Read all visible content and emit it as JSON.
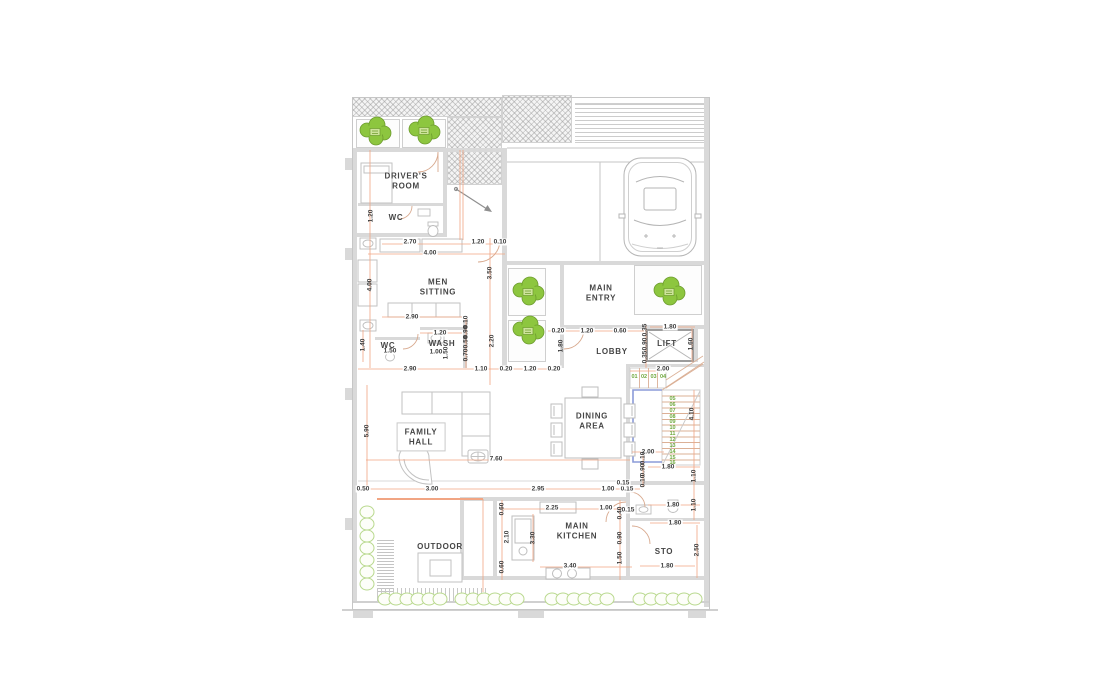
{
  "plan": {
    "rooms": [
      {
        "label": "DRIVER'S\nROOM",
        "x": 406,
        "y": 181
      },
      {
        "label": "WC",
        "x": 396,
        "y": 218
      },
      {
        "label": "MEN\nSITTING",
        "x": 438,
        "y": 287
      },
      {
        "label": "WASH",
        "x": 442,
        "y": 344
      },
      {
        "label": "WC",
        "x": 388,
        "y": 346
      },
      {
        "label": "MAIN\nENTRY",
        "x": 601,
        "y": 293
      },
      {
        "label": "LOBBY",
        "x": 612,
        "y": 352
      },
      {
        "label": "LIFT",
        "x": 667,
        "y": 344
      },
      {
        "label": "FAMILY\nHALL",
        "x": 421,
        "y": 437,
        "boxed": true
      },
      {
        "label": "DINING\nAREA",
        "x": 592,
        "y": 421
      },
      {
        "label": "MAIN\nKITCHEN",
        "x": 577,
        "y": 531
      },
      {
        "label": "STO",
        "x": 664,
        "y": 552
      },
      {
        "label": "OUTDOOR",
        "x": 440,
        "y": 547
      }
    ],
    "dims_horizontal": [
      {
        "t": "2.70",
        "x": 410,
        "y": 242
      },
      {
        "t": "4.00",
        "x": 430,
        "y": 253
      },
      {
        "t": "1.20",
        "x": 478,
        "y": 242
      },
      {
        "t": "0.10",
        "x": 500,
        "y": 242
      },
      {
        "t": "2.90",
        "x": 412,
        "y": 317
      },
      {
        "t": "1.20",
        "x": 440,
        "y": 333
      },
      {
        "t": "1.00",
        "x": 436,
        "y": 352
      },
      {
        "t": "1.50",
        "x": 390,
        "y": 351
      },
      {
        "t": "2.90",
        "x": 410,
        "y": 369
      },
      {
        "t": "1.10",
        "x": 481,
        "y": 369
      },
      {
        "t": "0.20",
        "x": 506,
        "y": 369
      },
      {
        "t": "1.20",
        "x": 530,
        "y": 369
      },
      {
        "t": "0.20",
        "x": 554,
        "y": 369
      },
      {
        "t": "0.20",
        "x": 558,
        "y": 331
      },
      {
        "t": "1.20",
        "x": 587,
        "y": 331
      },
      {
        "t": "0.60",
        "x": 620,
        "y": 331
      },
      {
        "t": "1.80",
        "x": 670,
        "y": 327
      },
      {
        "t": "2.00",
        "x": 663,
        "y": 369
      },
      {
        "t": "7.60",
        "x": 496,
        "y": 459
      },
      {
        "t": "2.00",
        "x": 648,
        "y": 452
      },
      {
        "t": "1.80",
        "x": 668,
        "y": 467
      },
      {
        "t": "0.50",
        "x": 363,
        "y": 489
      },
      {
        "t": "3.00",
        "x": 432,
        "y": 489
      },
      {
        "t": "2.95",
        "x": 538,
        "y": 489
      },
      {
        "t": "1.00",
        "x": 608,
        "y": 489
      },
      {
        "t": "0.15",
        "x": 627,
        "y": 489
      },
      {
        "t": "2.25",
        "x": 552,
        "y": 508
      },
      {
        "t": "1.00",
        "x": 606,
        "y": 508
      },
      {
        "t": "0.15",
        "x": 628,
        "y": 510
      },
      {
        "t": "3.40",
        "x": 570,
        "y": 566
      },
      {
        "t": "0.15",
        "x": 623,
        "y": 483
      },
      {
        "t": "1.80",
        "x": 673,
        "y": 505
      },
      {
        "t": "1.80",
        "x": 675,
        "y": 523
      },
      {
        "t": "1.80",
        "x": 667,
        "y": 566
      }
    ],
    "dims_vertical": [
      {
        "t": "1.20",
        "x": 371,
        "y": 216
      },
      {
        "t": "4.00",
        "x": 370,
        "y": 285
      },
      {
        "t": "3.50",
        "x": 490,
        "y": 273
      },
      {
        "t": "1.40",
        "x": 363,
        "y": 345
      },
      {
        "t": "0.10",
        "x": 466,
        "y": 322
      },
      {
        "t": "0.90",
        "x": 466,
        "y": 332
      },
      {
        "t": "0.50",
        "x": 466,
        "y": 342
      },
      {
        "t": "0.70",
        "x": 466,
        "y": 355
      },
      {
        "t": "1.50",
        "x": 446,
        "y": 353
      },
      {
        "t": "2.20",
        "x": 492,
        "y": 341
      },
      {
        "t": "1.80",
        "x": 561,
        "y": 346
      },
      {
        "t": "0.35",
        "x": 645,
        "y": 330
      },
      {
        "t": "0.90",
        "x": 645,
        "y": 344
      },
      {
        "t": "0.35",
        "x": 645,
        "y": 357
      },
      {
        "t": "1.60",
        "x": 691,
        "y": 344
      },
      {
        "t": "5.90",
        "x": 367,
        "y": 431
      },
      {
        "t": "4.10",
        "x": 692,
        "y": 414
      },
      {
        "t": "0.10",
        "x": 643,
        "y": 458
      },
      {
        "t": "0.90",
        "x": 643,
        "y": 470
      },
      {
        "t": "0.10",
        "x": 643,
        "y": 481
      },
      {
        "t": "1.10",
        "x": 694,
        "y": 476
      },
      {
        "t": "1.10",
        "x": 694,
        "y": 505
      },
      {
        "t": "0.60",
        "x": 502,
        "y": 509
      },
      {
        "t": "2.10",
        "x": 507,
        "y": 537
      },
      {
        "t": "3.30",
        "x": 533,
        "y": 538
      },
      {
        "t": "0.60",
        "x": 502,
        "y": 567
      },
      {
        "t": "0.40",
        "x": 620,
        "y": 513
      },
      {
        "t": "0.90",
        "x": 620,
        "y": 538
      },
      {
        "t": "1.50",
        "x": 620,
        "y": 558
      },
      {
        "t": "2.50",
        "x": 697,
        "y": 550
      }
    ],
    "stair_steps_upper": [
      "01",
      "02",
      "03",
      "04"
    ],
    "stair_steps_lower": [
      "05",
      "06",
      "07",
      "08",
      "09",
      "10",
      "11",
      "12",
      "13",
      "14",
      "15",
      "16"
    ],
    "colors": {
      "dimension_line": "#f1a583",
      "dimension_text": "#3d3d3d",
      "room_text": "#454545",
      "wall_gray": "#d9d9d9",
      "plant_green": "#8dc63f",
      "plant_outline": "#6d9c2e",
      "bush_green": "#b9d98e",
      "stair_number_green": "#6fa83d",
      "stair_outline_blue": "#8b9bd8"
    }
  }
}
